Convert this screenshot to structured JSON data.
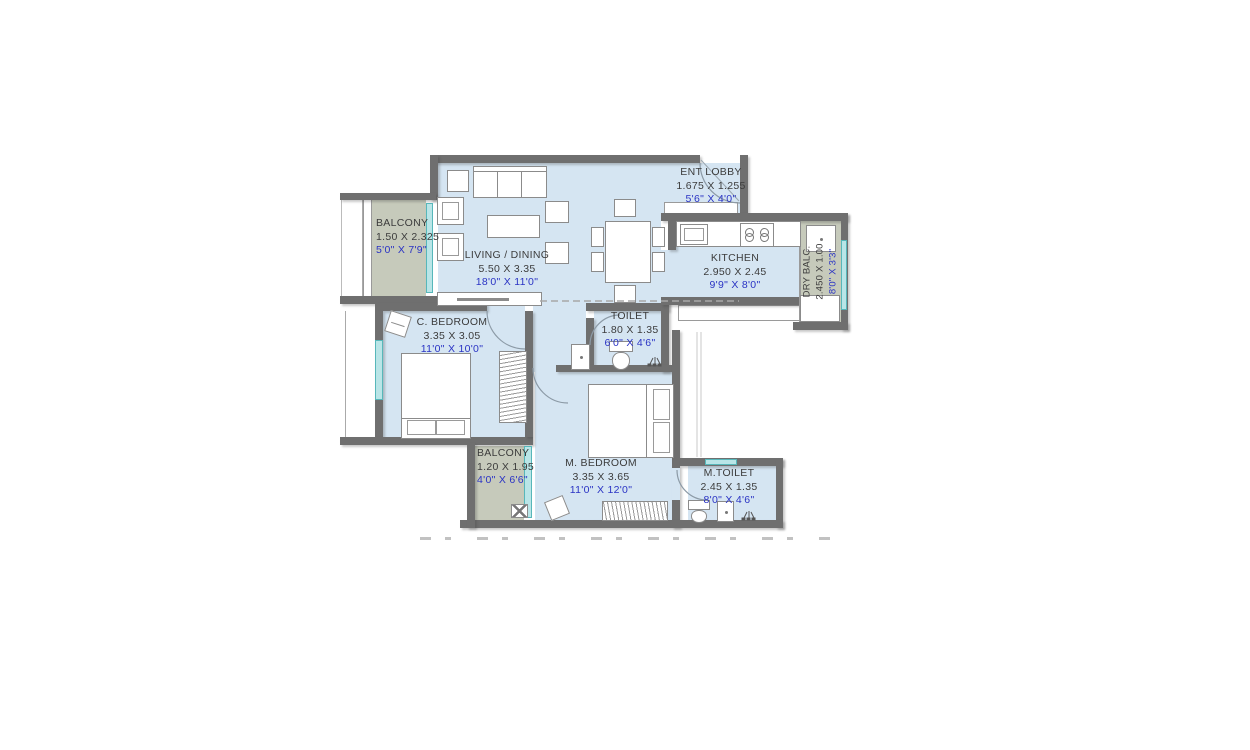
{
  "plan_title": "2 BHK apartment floor plan",
  "colors": {
    "room_fill": "#d5e5f2",
    "balcony_fill": "#c6cabb",
    "wall": "#6f6f6f",
    "window": "#b9e5e7",
    "label_dark": "#3c3c3c",
    "label_blue": "#2a33c4"
  },
  "rooms": [
    {
      "id": "balcony_top",
      "name": "BALCONY",
      "metric": "1.50 X 2.325",
      "imperial": "5'0\" X 7'9\""
    },
    {
      "id": "living_dining",
      "name": "LIVING / DINING",
      "metric": "5.50 X 3.35",
      "imperial": "18'0\" X 11'0\""
    },
    {
      "id": "ent_lobby",
      "name": "ENT LOBBY",
      "metric": "1.675 X 1.255",
      "imperial": "5'6\" X 4'0\""
    },
    {
      "id": "kitchen",
      "name": "KITCHEN",
      "metric": "2.950 X 2.45",
      "imperial": "9'9\" X 8'0\""
    },
    {
      "id": "dry_balcony",
      "name": "DRY BALC.",
      "metric": "2.450 X 1.00",
      "imperial": "8'0\" X 3'3\""
    },
    {
      "id": "c_bedroom",
      "name": "C. BEDROOM",
      "metric": "3.35 X 3.05",
      "imperial": "11'0\" X 10'0\""
    },
    {
      "id": "toilet",
      "name": "TOILET",
      "metric": "1.80 X 1.35",
      "imperial": "6'0\" X 4'6\""
    },
    {
      "id": "balcony_bottom",
      "name": "BALCONY",
      "metric": "1.20 X 1.95",
      "imperial": "4'0\" X 6'6\""
    },
    {
      "id": "m_bedroom",
      "name": "M. BEDROOM",
      "metric": "3.35 X 3.65",
      "imperial": "11'0\" X 12'0\""
    },
    {
      "id": "m_toilet",
      "name": "M.TOILET",
      "metric": "2.45 X 1.35",
      "imperial": "8'0\" X 4'6\""
    }
  ]
}
